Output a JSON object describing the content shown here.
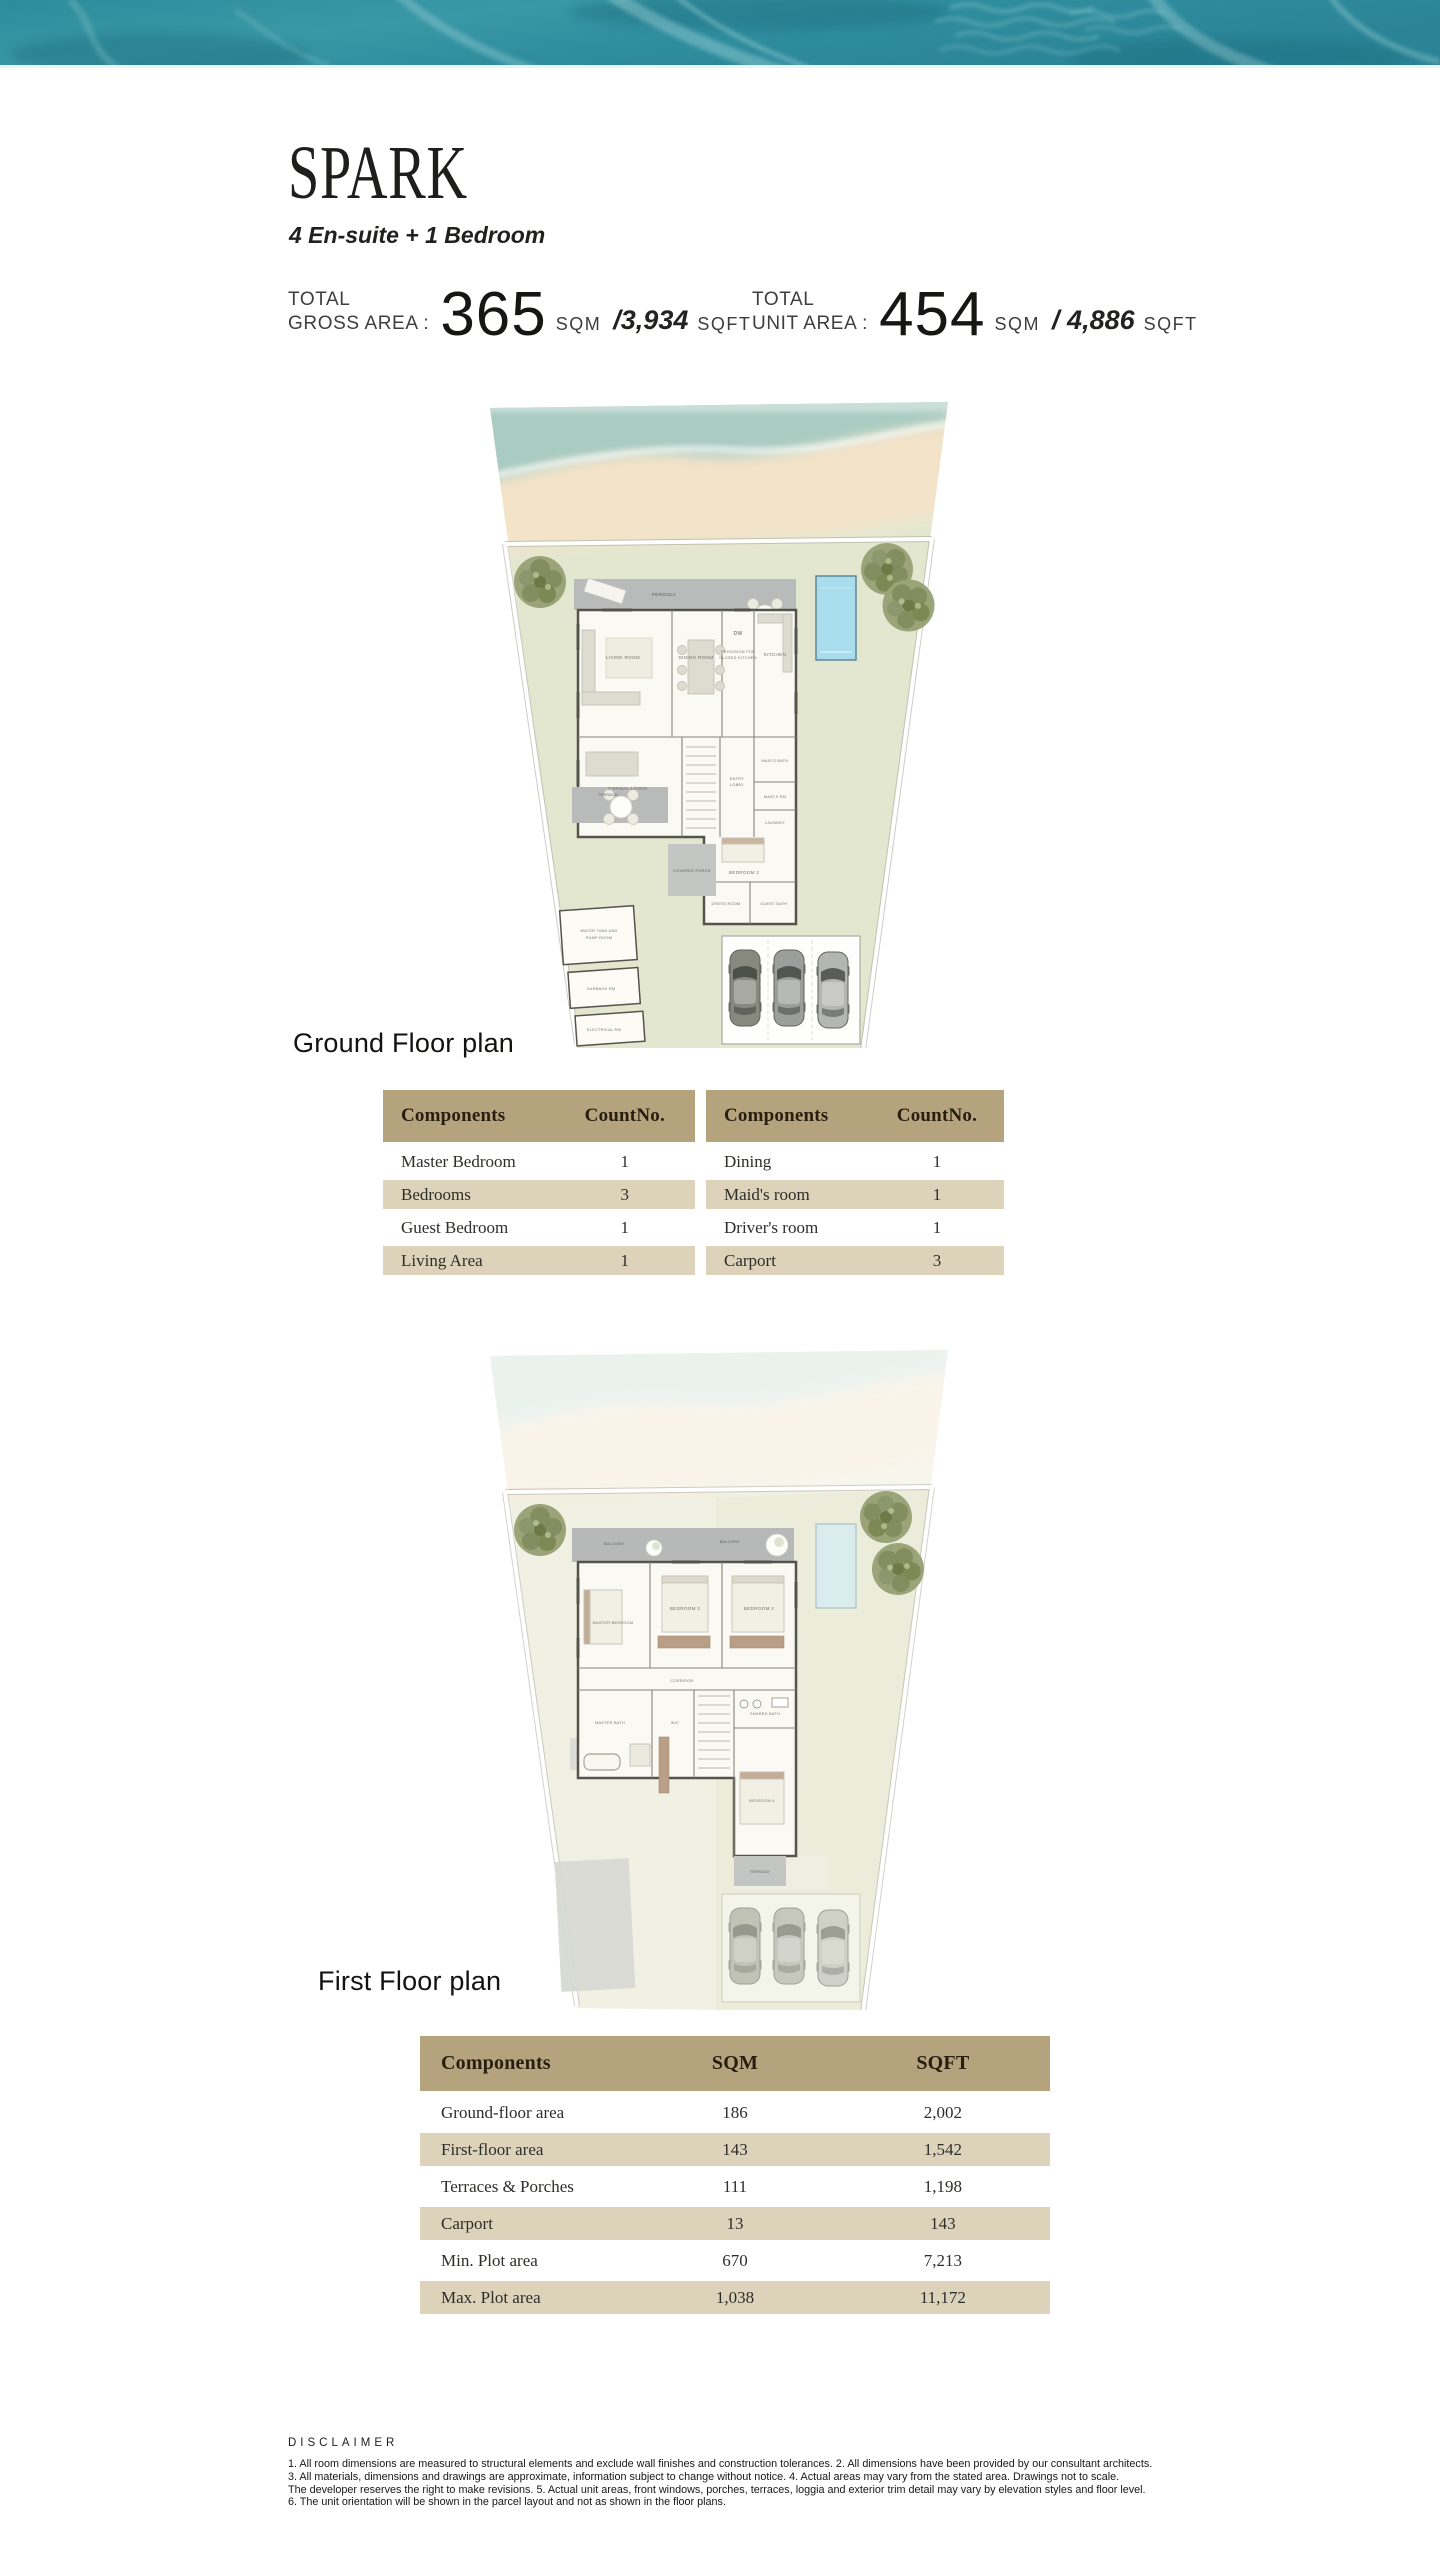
{
  "header": {
    "title": "SPARK",
    "subtitle": "4 En-suite + 1 Bedroom"
  },
  "areas": {
    "gross": {
      "l1": "TOTAL",
      "l2": "GROSS AREA :",
      "value": "365",
      "unit": "SQM",
      "alt": "/3,934",
      "alt_unit": "SQFT"
    },
    "unit": {
      "l1": "TOTAL",
      "l2": "UNIT AREA :",
      "value": "454",
      "unit": "SQM",
      "alt": "/ 4,886",
      "alt_unit": "SQFT"
    }
  },
  "plans": {
    "ground": {
      "caption": "Ground Floor plan",
      "rooms": [
        "PERGOLA",
        "LIVING ROOM",
        "DINING ROOM",
        "PROVISION FOR",
        "CLOSED KITCHEN",
        "KITCHEN",
        "DW",
        "FORMAL LIVING",
        "ENTRY",
        "LOBBY",
        "TERRACE",
        "MAID'S BATH",
        "MAID'S RM",
        "LAUNDRY",
        "BEDROOM 2",
        "DRESS ROOM",
        "GUEST BATH",
        "COVERED PORCH",
        "WATER TANK AND",
        "PUMP ROOM",
        "GARBAGE RM",
        "ELECTRICAL RM"
      ]
    },
    "first": {
      "caption": "First Floor plan",
      "rooms": [
        "BALCONY",
        "MASTER BEDROOM",
        "BEDROOM 3",
        "BEDROOM 2",
        "CORRIDOR",
        "MASTER BATH",
        "WIC",
        "SHARED BATH",
        "BEDROOM 4",
        "TERRACE"
      ]
    }
  },
  "tables": {
    "left": {
      "h": [
        "Components",
        "CountNo."
      ],
      "rows": [
        [
          "Master Bedroom",
          "1"
        ],
        [
          "Bedrooms",
          "3"
        ],
        [
          "Guest Bedroom",
          "1"
        ],
        [
          "Living Area",
          "1"
        ]
      ]
    },
    "right": {
      "h": [
        "Components",
        "CountNo."
      ],
      "rows": [
        [
          "Dining",
          "1"
        ],
        [
          "Maid's room",
          "1"
        ],
        [
          "Driver's room",
          "1"
        ],
        [
          "Carport",
          "3"
        ]
      ]
    },
    "areas": {
      "h": [
        "Components",
        "SQM",
        "SQFT"
      ],
      "rows": [
        [
          "Ground-floor area",
          "186",
          "2,002"
        ],
        [
          "First-floor area",
          "143",
          "1,542"
        ],
        [
          "Terraces & Porches",
          "111",
          "1,198"
        ],
        [
          "Carport",
          "13",
          "143"
        ],
        [
          "Min. Plot area",
          "670",
          "7,213"
        ],
        [
          "Max. Plot area",
          "1,038",
          "11,172"
        ]
      ]
    }
  },
  "disclaimer": {
    "heading": "DISCLAIMER",
    "lines": [
      "1. All room dimensions are measured to structural elements and exclude wall finishes and construction tolerances. 2. All dimensions have been provided by our consultant architects.",
      "3. All materials, dimensions and drawings are approximate, information subject to change without notice. 4. Actual areas may vary from the stated area. Drawings not to scale.",
      "The developer reserves the right to make revisions. 5. Actual unit areas, front windows, porches, terraces, loggia and exterior trim detail may vary by elevation styles and floor level.",
      "6. The unit orientation will be shown in the parcel layout and not as shown in the floor plans."
    ]
  },
  "colors": {
    "banner_teal": "#338f9f",
    "banner_light": "#7ecbd2",
    "table_header_bg": "#b4a37c",
    "table_row_alt": "#ddd3ba",
    "lawn": "#e4e7cf",
    "sand": "#f3e3c9",
    "water_wash": "#9fc6c0",
    "pool": "#a9dcec",
    "slab_gray": "#b8bbb9",
    "tree_green": "#8a966c"
  }
}
